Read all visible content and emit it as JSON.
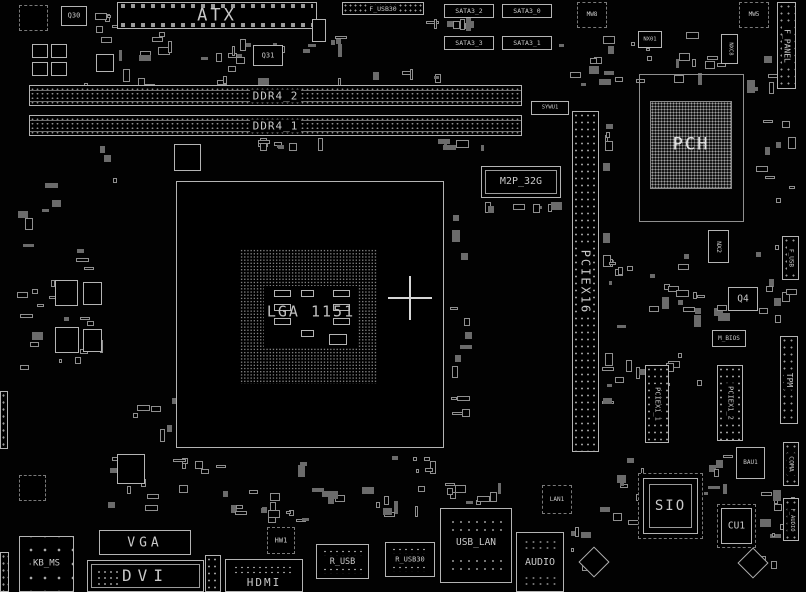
{
  "colors": {
    "background": "#000000",
    "line": "#b4b4b4",
    "text": "#c9c9c9",
    "dim": "#8f8f8f"
  },
  "top": {
    "q30": "Q30",
    "q31": "Q31",
    "atx": "ATX",
    "f_usb30": "F_USB30",
    "sata3_2": "SATA3_2",
    "sata3_0": "SATA3_0",
    "sata3_3": "SATA3_3",
    "sata3_1": "SATA3_1",
    "mw8": "MW8",
    "mw5": "MW5",
    "nx01": "NX01",
    "nxc8": "NXC8",
    "f_panel": "F_PANEL"
  },
  "memory": {
    "ddr4_2": "DDR4_2",
    "ddr4_1": "DDR4_1",
    "sywu1": "SYWU1"
  },
  "cpu": {
    "socket": "LGA 1151"
  },
  "storage": {
    "m2p": "M2P_32G"
  },
  "expansion": {
    "pciex16": "PCIEX16",
    "pciex1_1": "PCIEX1_1",
    "pciex1_2": "PCIEX1_2"
  },
  "chipset": {
    "pch": "PCH",
    "nx2": "NX2",
    "q4": "Q4",
    "m_bios": "M_BIOS",
    "f_usb": "F_USB"
  },
  "right": {
    "tpm": "TPM",
    "coma": "COMA",
    "f_audio": "F_AUDIO",
    "bau1": "BAU1",
    "sio": "SIO",
    "cu1": "CU1"
  },
  "rear_io": {
    "kb_ms": "KB_MS",
    "vga": "VGA",
    "dvi": "DVI",
    "hdmi": "HDMI",
    "r_usb": "R_USB",
    "r_usb30": "R_USB30",
    "usb_lan": "USB_LAN",
    "audio": "AUDIO"
  },
  "bottom": {
    "hw1": "HW1",
    "lan1": "LAN1"
  }
}
